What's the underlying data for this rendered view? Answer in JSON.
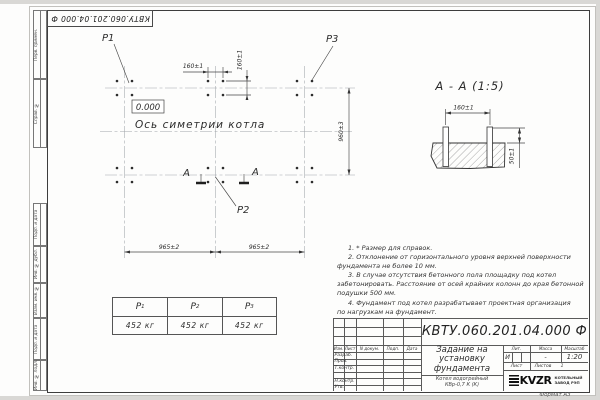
{
  "doc_number": "КВТУ.060.201.04.000  Ф",
  "frame": {
    "left_strip": [
      "Перв. примен.",
      "Справ. №",
      "Подп. и дата",
      "Инв. № дубл.",
      "Взам. инв. №",
      "Подп. и дата",
      "Инв. № подл."
    ],
    "format_label": "Формат А3"
  },
  "plan": {
    "point_labels": {
      "p1": "P1",
      "p2": "P2",
      "p3": "P3"
    },
    "elevation": "0.000",
    "axis_label": "Ось симетрии котла",
    "section_letter": "А",
    "dims": {
      "bolt_h": "160±1",
      "bolt_v": "160±1",
      "span_left": "965±2",
      "span_right": "965±2",
      "row_span": "960±3"
    }
  },
  "section": {
    "title": "А - А (1:5)",
    "dims": {
      "bolt_spacing": "160±1",
      "protrusion": "50±1"
    }
  },
  "notes": {
    "lines": [
      "1. * Размер для справок.",
      "2. Отклонение от горизонтального уровня верхней поверхности",
      "фундамента не более 10 мм.",
      "3. В случае отсутствия бетонного пола площадку под котел",
      "забетонировать. Расстояние от осей крайних колонн до края бетонной",
      "подушки 500 мм.",
      "4. Фундамент под котел разрабатывает проектная организация",
      "по нагрузкам на фундамент."
    ]
  },
  "load_table": {
    "columns": [
      {
        "symbol": "P",
        "sub": "1",
        "value": "452 кг"
      },
      {
        "symbol": "P",
        "sub": "2",
        "value": "452 кг"
      },
      {
        "symbol": "P",
        "sub": "3",
        "value": "452 кг"
      }
    ]
  },
  "title_block": {
    "cols": {
      "izm": "Изм.",
      "list": "Лист",
      "doc": "N докум.",
      "sign": "Подп.",
      "date": "Дата"
    },
    "rows": [
      "Разраб.",
      "Пров.",
      "Т.контр.",
      "",
      "Н.контр.",
      "Утв."
    ],
    "title_lines": [
      "Задание на",
      "установку",
      "фундамента"
    ],
    "lit_label": "Лит.",
    "lit_value": "И",
    "mass_label": "Масса",
    "mass_value": "-",
    "scale_label": "Масштаб",
    "scale_value": "1:20",
    "sheet_label": "Лист",
    "sheets_label": "Листов",
    "sheets_value": "1",
    "product_lines": [
      "Котел водогрейный",
      "КВр-0,7 К (К)"
    ],
    "company": {
      "logo_text": "KVZR",
      "name_lines": [
        "КОТЕЛЬНЫЙ",
        "ЗАВОД РЭП"
      ]
    }
  }
}
